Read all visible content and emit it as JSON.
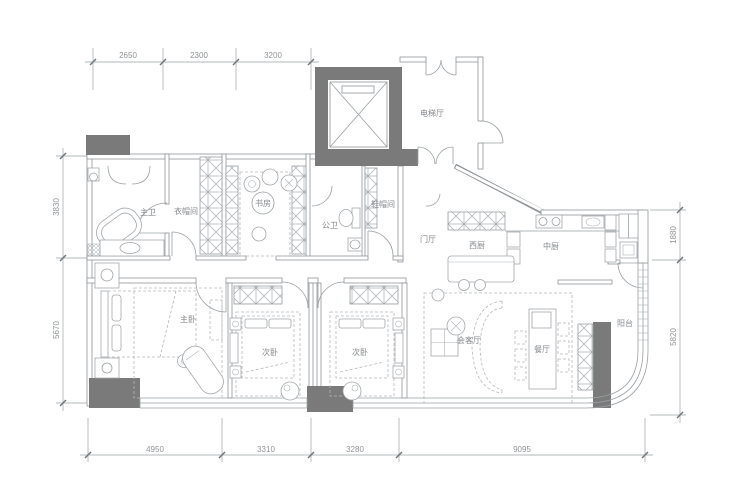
{
  "title": "residential floor plan",
  "colors": {
    "background": "#ffffff",
    "line": "#9aa0a4",
    "wall_fill": "#7a7a7a",
    "furniture_dash": "#b4b9bd",
    "text": "#85898d",
    "dimension_text": "#8f9396"
  },
  "rooms": {
    "master_bath": "主卫",
    "closet": "衣帽间",
    "study": "书房",
    "public_bath": "公卫",
    "cloak_room": "鞋帽间",
    "elevator_hall": "电梯厅",
    "foyer": "门厅",
    "west_kitchen": "西厨",
    "chinese_kitchen": "中厨",
    "master_bedroom": "主卧",
    "bedroom_2": "次卧",
    "bedroom_3": "次卧",
    "living_room": "会客厅",
    "dining_room": "餐厅",
    "balcony": "阳台"
  },
  "dimensions": {
    "top": [
      "2650",
      "2300",
      "3200"
    ],
    "left": [
      "3830",
      "5670"
    ],
    "right": [
      "1880",
      "5820"
    ],
    "bottom": [
      "4950",
      "3310",
      "3280",
      "9095"
    ]
  }
}
